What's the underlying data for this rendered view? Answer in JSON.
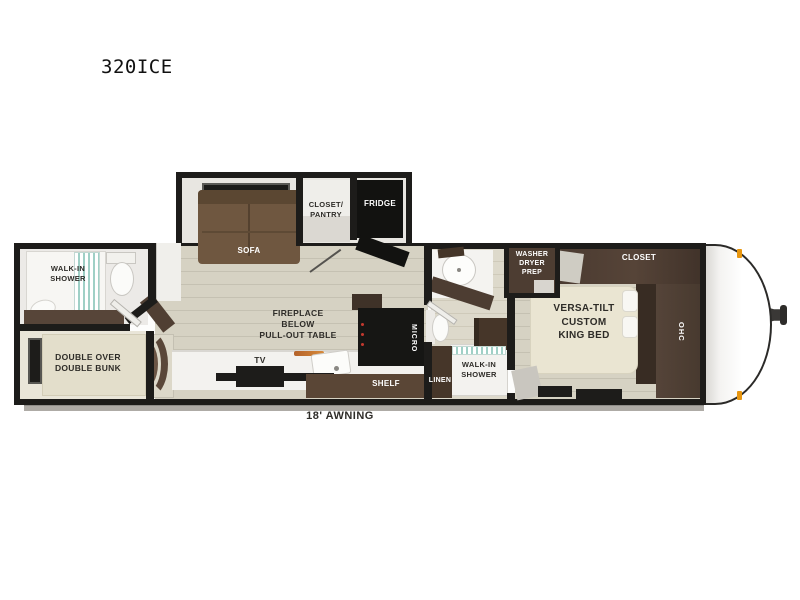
{
  "model": {
    "label": "320ICE"
  },
  "awning": {
    "label": "18' AWNING"
  },
  "labels": {
    "rear_shower": "WALK-IN\nSHOWER",
    "bunk": "DOUBLE OVER\nDOUBLE BUNK",
    "sofa": "SOFA",
    "closet_pantry": "CLOSET/\nPANTRY",
    "fridge": "FRIDGE",
    "fireplace": "FIREPLACE\nBELOW\nPULL-OUT TABLE",
    "tv": "TV",
    "shelf": "SHELF",
    "micro": "MICRO",
    "mid_shower": "WALK-IN\nSHOWER",
    "linen": "LINEN",
    "washer_dryer_prep": "WASHER\nDRYER\nPREP",
    "king_bed": "VERSA-TILT\nCUSTOM\nKING BED",
    "closet": "CLOSET",
    "ohc": "OHC"
  },
  "colors": {
    "wall_black": "#1d1c1a",
    "floor_wood": "#d6d2c3",
    "floor_light": "#eceae7",
    "cabinet_dark": "#4a3a30",
    "sofa_brown": "#6f5740",
    "bed_cream": "#eae5d2",
    "appliance_black": "#141412",
    "shower_teal": "#9fd0c6",
    "marker_orange": "#e8960f",
    "awning_gray": "#aeaba6"
  }
}
